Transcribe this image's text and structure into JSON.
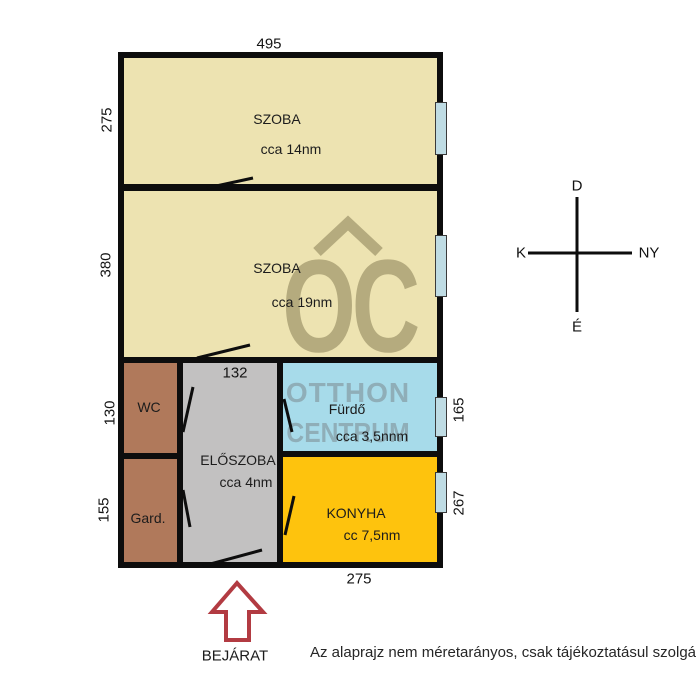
{
  "dimensions": {
    "top": "495",
    "left_szoba1": "275",
    "left_szoba2": "380",
    "left_wc": "130",
    "left_gard": "155",
    "eloszoba_width": "132",
    "right_furdo": "165",
    "right_konyha": "267",
    "bottom": "275"
  },
  "rooms": {
    "szoba1": {
      "label": "SZOBA",
      "area": "cca 14nm"
    },
    "szoba2": {
      "label": "SZOBA",
      "area": "cca 19nm"
    },
    "wc": {
      "label": "WC"
    },
    "gard": {
      "label": "Gard."
    },
    "eloszoba": {
      "label": "ELŐSZOBA",
      "area": "cca 4nm"
    },
    "furdo": {
      "label": "Fürdő",
      "area": "cca 3,5nnm"
    },
    "konyha": {
      "label": "KONYHA",
      "area": "cc 7,5nm"
    }
  },
  "compass": {
    "top": "D",
    "bottom": "É",
    "left": "K",
    "right": "NY"
  },
  "entrance": {
    "label": "BEJÁRAT"
  },
  "watermark": {
    "logo": "OC",
    "line1": "OTTHON",
    "line2": "CENTRUM"
  },
  "disclaimer": "Az alaprajz nem méretarányos, csak tájékoztatásul szolgál.",
  "colors": {
    "wall": "#0d0d0d",
    "szoba_fill": "#ede3b1",
    "wc_gard_fill": "#b0795b",
    "eloszoba_fill": "#c2c1c1",
    "furdo_fill": "#a7dbea",
    "konyha_fill": "#fec30d",
    "window_fill": "#bfdce4",
    "entrance_arrow": "#b23b42",
    "watermark_on_beige": "#b5ab7e",
    "watermark_on_blue": "#8faeb8"
  }
}
